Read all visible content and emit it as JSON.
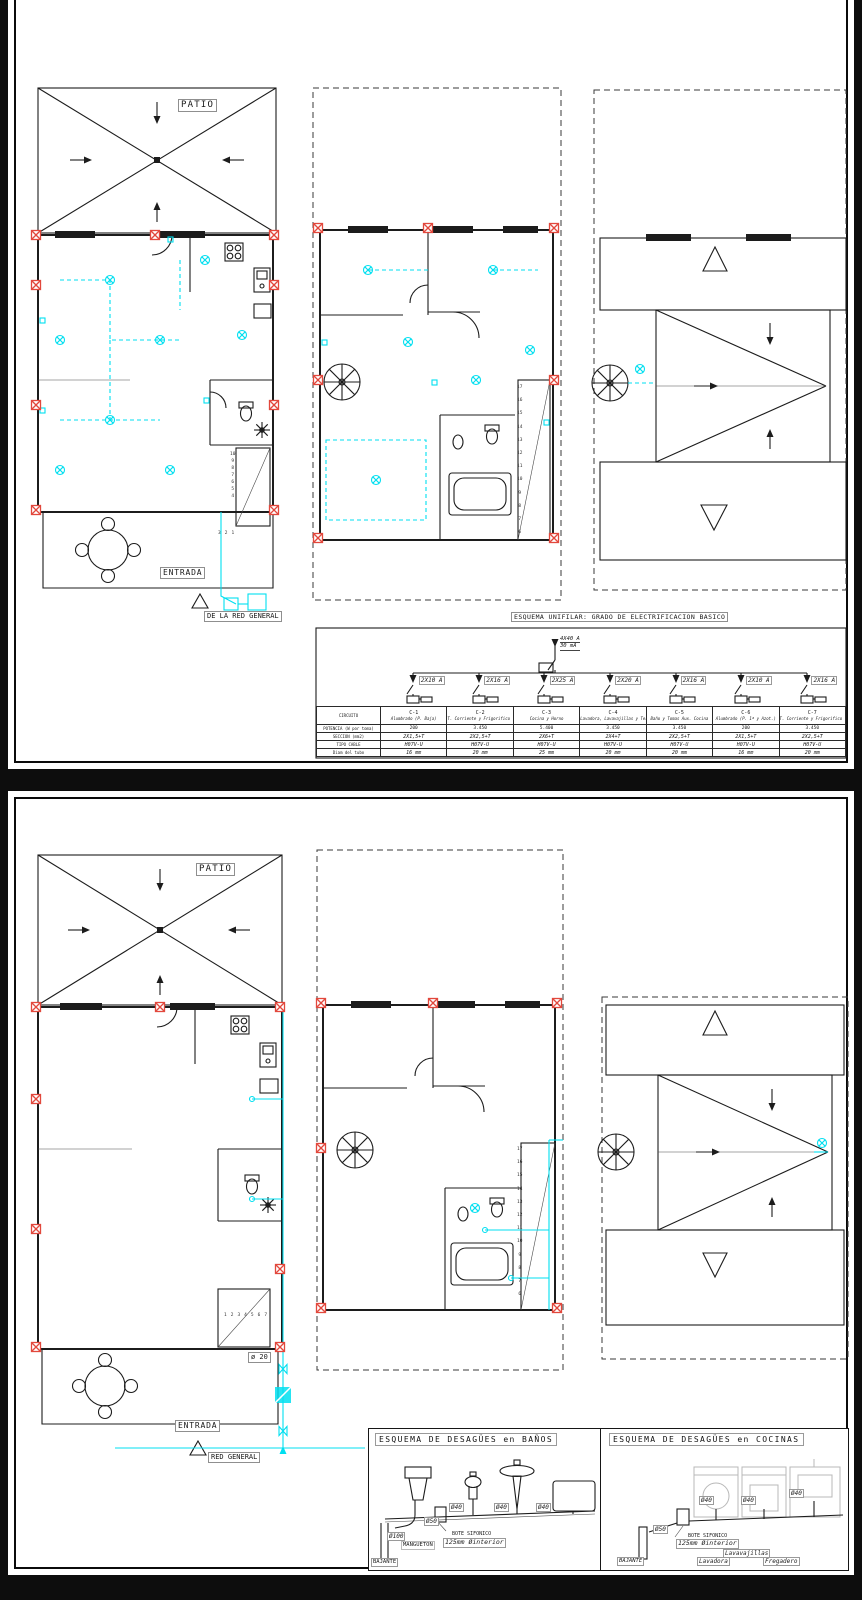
{
  "theme": {
    "bg": "#0d0d0d",
    "paper": "#ffffff",
    "cyan": "#00dff0",
    "red": "#e2483d"
  },
  "sheet_top": {
    "ground": {
      "patio": "PATIO",
      "entrada": "ENTRADA",
      "red_general": "DE LA RED GENERAL",
      "stair_numbers_v": [
        "10",
        "9",
        "8",
        "7",
        "6",
        "5",
        "4"
      ],
      "stair_numbers_h": [
        "3",
        "2",
        "1"
      ]
    },
    "first": {
      "stair_numbers": [
        "17",
        "16",
        "15",
        "14",
        "13",
        "12",
        "11",
        "10",
        "9",
        "8",
        "7",
        "6"
      ]
    },
    "unifilar": {
      "title": "ESQUEMA UNIFILAR: GRADO DE ELECTRIFICACION BASICO",
      "main_breaker": "4X40 A",
      "main_diff": "30 mA",
      "branches": [
        "2X10 A",
        "2X16 A",
        "2X25 A",
        "2X20 A",
        "2X16 A",
        "2X10 A",
        "2X16 A"
      ],
      "table": {
        "rows": [
          "CIRCUITO",
          "POTENCIA (W por toma)",
          "SECCION (mm2)",
          "TIPO CABLE",
          "Diam del tubo"
        ],
        "ids": [
          "C-1",
          "C-2",
          "C-3",
          "C-4",
          "C-5",
          "C-6",
          "C-7"
        ],
        "names": [
          "Alumbrado (P. Baja)",
          "T. Corriente y Frigorifico (P. Baja)",
          "Cocina y Horno",
          "Lavadora, Lavavajillas y Termo Elect.",
          "Baño y Tomas Aux. Cocina",
          "Alumbrado (P. 1ª y Azot.)",
          "T. Corriente y Frigorifico (P. 1ª y Azot.)"
        ],
        "potencia": [
          "200",
          "3.450",
          "5.400",
          "3.450",
          "3.450",
          "200",
          "3.450"
        ],
        "seccion": [
          "2X1,5+T",
          "2X2,5+T",
          "2X6+T",
          "2X4+T",
          "2X2,5+T",
          "2X1,5+T",
          "2X2,5+T"
        ],
        "cable": [
          "H07V-U",
          "H07V-U",
          "H07V-U",
          "H07V-U",
          "H07V-U",
          "H07V-U",
          "H07V-U"
        ],
        "tubo": [
          "16 mm",
          "20 mm",
          "25 mm",
          "20 mm",
          "20 mm",
          "16 mm",
          "20 mm"
        ]
      }
    }
  },
  "sheet_bottom": {
    "ground": {
      "patio": "PATIO",
      "entrada": "ENTRADA",
      "diam": "ø 20",
      "red_general": "RED GENERAL",
      "stair_numbers_h": [
        "1",
        "2",
        "3",
        "4",
        "5",
        "6",
        "7"
      ]
    },
    "first": {
      "stair_numbers": [
        "17",
        "16",
        "15",
        "14",
        "13",
        "12",
        "11",
        "10",
        "9",
        "8",
        "7",
        "6"
      ]
    },
    "banos": {
      "title": "ESQUEMA DE DESAGÜES en BAÑOS",
      "d100": "Ø100",
      "mangueton": "MANGUETON",
      "d50": "Ø50",
      "bote_l1": "BOTE SIFONICO",
      "bote_l2": "125mm  Øinterior",
      "d40_1": "Ø40",
      "d40_2": "Ø40",
      "d40_3": "Ø40",
      "bajante": "BAJANTE"
    },
    "cocinas": {
      "title": "ESQUEMA DE DESAGÜES en COCINAS",
      "d40_1": "Ø40",
      "d40_2": "Ø40",
      "d40_3": "Ø40",
      "d50": "Ø50",
      "bote_l1": "BOTE SIFONICO",
      "bote_l2": "125mm  Øinterior",
      "bajante": "BAJANTE",
      "lavadora": "Lavadora",
      "lavavajillas": "Lavavajillas",
      "fregadero": "Fregadero"
    }
  }
}
